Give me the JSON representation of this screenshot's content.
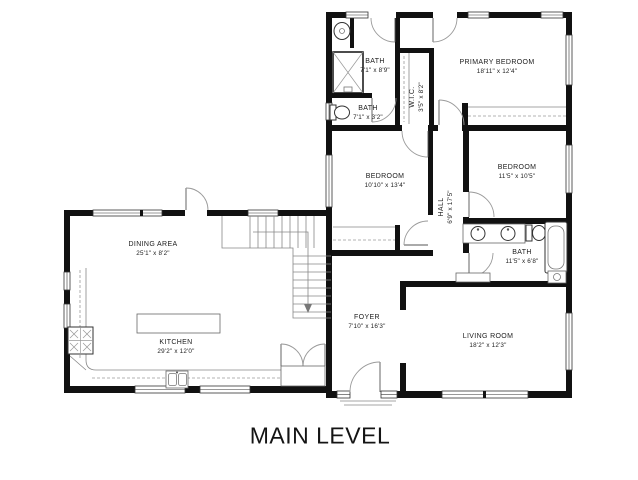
{
  "title": "MAIN LEVEL",
  "colors": {
    "wall": "#111111",
    "line": "#888888",
    "background": "#ffffff",
    "text": "#1c1c1c"
  },
  "rooms": [
    {
      "id": "bath-ensuite",
      "label": "BATH",
      "dims": "7'1\" x 8'9\"",
      "orientation": "horizontal"
    },
    {
      "id": "bath-half",
      "label": "BATH",
      "dims": "7'1\" x 3'2\"",
      "orientation": "horizontal"
    },
    {
      "id": "walk-in-closet",
      "label": "W.I.C.",
      "dims": "3'5\" x 8'2\"",
      "orientation": "vertical"
    },
    {
      "id": "primary-bedroom",
      "label": "PRIMARY BEDROOM",
      "dims": "18'11\" x 12'4\"",
      "orientation": "horizontal"
    },
    {
      "id": "bedroom-middle",
      "label": "BEDROOM",
      "dims": "10'10\" x 13'4\"",
      "orientation": "horizontal"
    },
    {
      "id": "bedroom-right",
      "label": "BEDROOM",
      "dims": "11'5\" x 10'5\"",
      "orientation": "horizontal"
    },
    {
      "id": "hall",
      "label": "HALL",
      "dims": "6'9\" x 17'5\"",
      "orientation": "vertical"
    },
    {
      "id": "bath-main",
      "label": "BATH",
      "dims": "11'5\" x 6'8\"",
      "orientation": "horizontal"
    },
    {
      "id": "dining-area",
      "label": "DINING AREA",
      "dims": "25'1\" x 8'2\"",
      "orientation": "horizontal"
    },
    {
      "id": "kitchen",
      "label": "KITCHEN",
      "dims": "29'2\" x 12'0\"",
      "orientation": "horizontal"
    },
    {
      "id": "foyer",
      "label": "FOYER",
      "dims": "7'10\" x 16'3\"",
      "orientation": "horizontal"
    },
    {
      "id": "living-room",
      "label": "LIVING ROOM",
      "dims": "18'2\" x 12'3\"",
      "orientation": "horizontal"
    }
  ]
}
